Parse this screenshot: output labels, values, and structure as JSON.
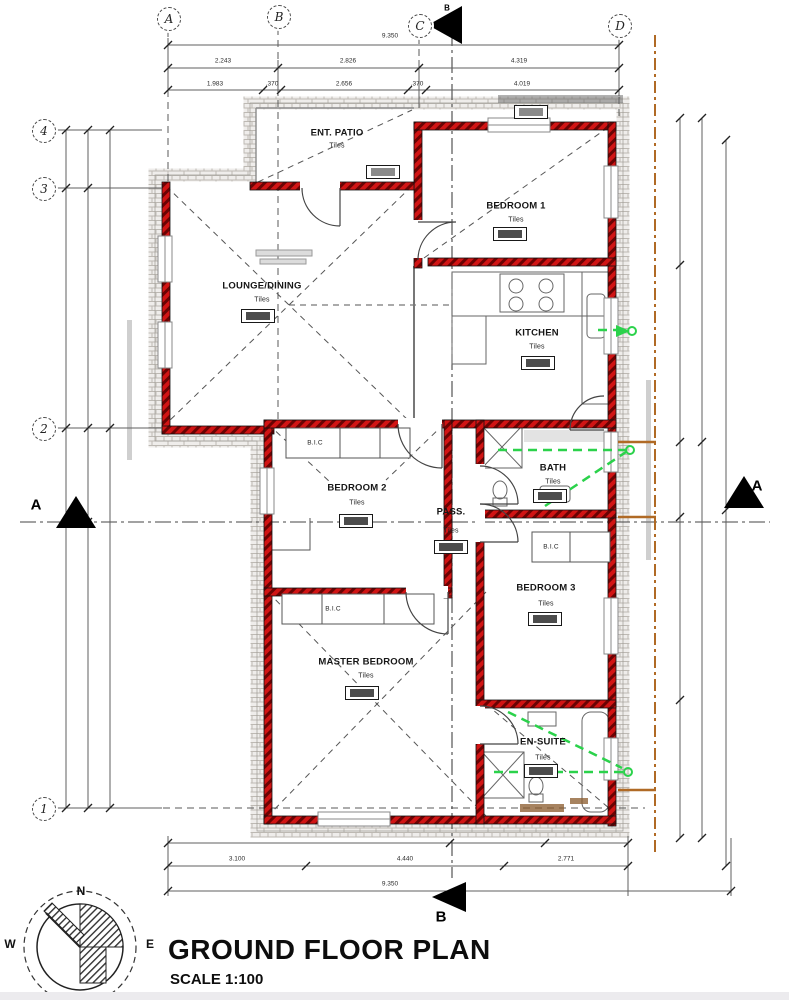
{
  "title": {
    "heading": "GROUND FLOOR PLAN",
    "scale": "SCALE 1:100"
  },
  "grid": {
    "columns": [
      "A",
      "B",
      "C",
      "D"
    ],
    "rows": [
      "4",
      "3",
      "2",
      "1"
    ]
  },
  "sections": {
    "a": "A",
    "b": "B"
  },
  "compass": {
    "north": "N",
    "east": "E",
    "west": "W"
  },
  "closet_label": "B.I.C",
  "rooms": [
    {
      "name": "ENT. PATIO",
      "floor": "Tiles"
    },
    {
      "name": "BEDROOM 1",
      "floor": "Tiles"
    },
    {
      "name": "LOUNGE/DINING",
      "floor": "Tiles"
    },
    {
      "name": "KITCHEN",
      "floor": "Tiles"
    },
    {
      "name": "BEDROOM 2",
      "floor": "Tiles"
    },
    {
      "name": "PASS.",
      "floor": "Tiles"
    },
    {
      "name": "BATH",
      "floor": "Tiles"
    },
    {
      "name": "BEDROOM 3",
      "floor": "Tiles"
    },
    {
      "name": "MASTER BEDROOM",
      "floor": "Tiles"
    },
    {
      "name": "EN-SUITE",
      "floor": "Tiles"
    }
  ],
  "dimensions": {
    "top_overall": "9.350",
    "top_row1": [
      "2.243",
      "2.826",
      "4.319"
    ],
    "top_row2": [
      "1.983",
      ".370",
      "2.656",
      ".370",
      "4.019"
    ],
    "bottom_row": [
      "3.100",
      "4.440",
      "2.771"
    ],
    "bottom_overall": "9.350"
  },
  "colors": {
    "wall_red": "#c41212",
    "drain_green": "#2bd24b",
    "boundary_orange": "#b06a25"
  }
}
